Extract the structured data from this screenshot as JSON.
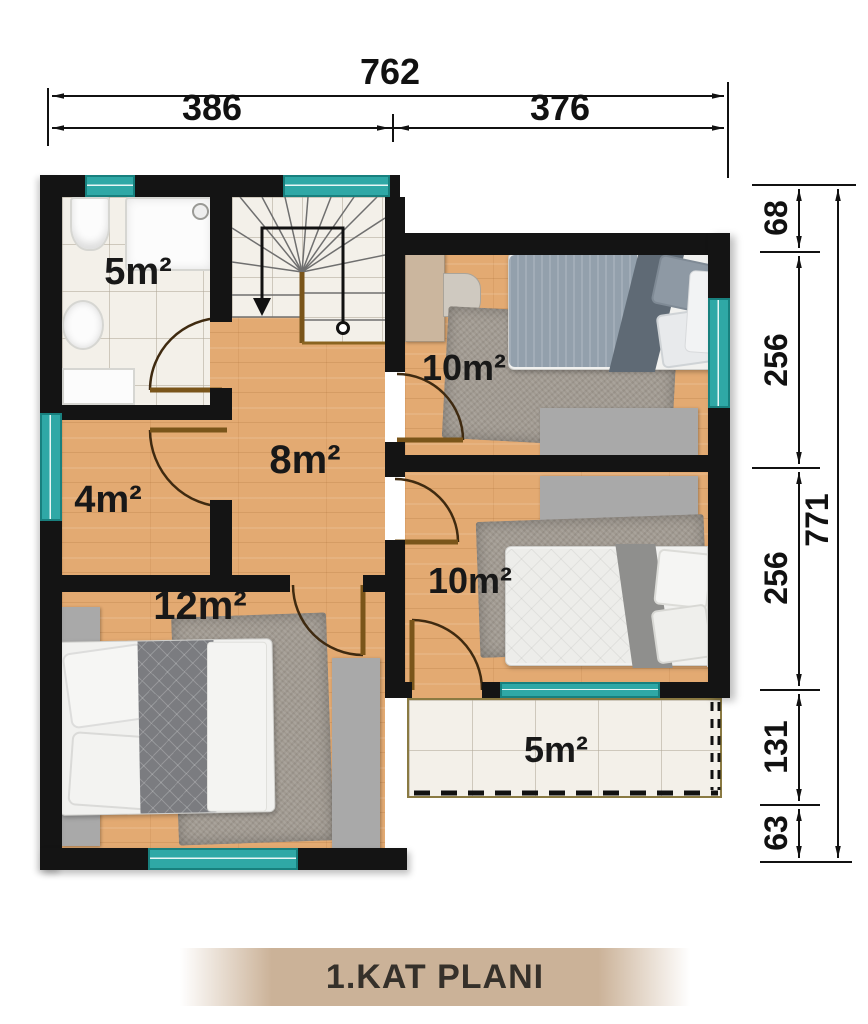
{
  "title": "1.KAT PLANI",
  "dimensions": {
    "top": {
      "total": "762",
      "segments": [
        "386",
        "376"
      ]
    },
    "right": {
      "total": "771",
      "segments": [
        "68",
        "256",
        "256",
        "131",
        "63"
      ]
    }
  },
  "rooms": [
    {
      "id": "bathroom",
      "area": "5m²"
    },
    {
      "id": "bedroom-upper-right",
      "area": "10m²"
    },
    {
      "id": "hall",
      "area": "8m²"
    },
    {
      "id": "closet-room",
      "area": "4m²"
    },
    {
      "id": "bedroom-left",
      "area": "12m²"
    },
    {
      "id": "bedroom-lower-right",
      "area": "10m²"
    },
    {
      "id": "balcony",
      "area": "5m²"
    }
  ],
  "colors": {
    "wall": "#141414",
    "window_teal": "#2fa8a6",
    "wood_floor": "#e3aa72",
    "tile_floor": "#f3f0e9",
    "furniture_gray": "#a9a9a9",
    "door_brown": "#7a551a",
    "banner_tan": "#cbb298"
  }
}
